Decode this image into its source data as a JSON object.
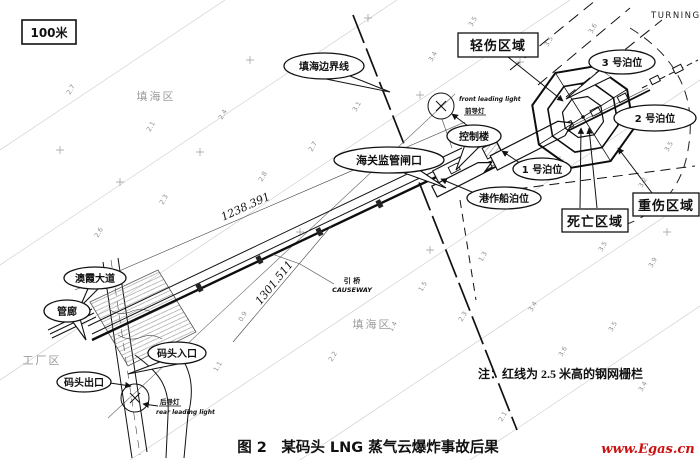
{
  "figure": {
    "scale": "100米",
    "turning": "TURNING",
    "caption": "图 2　某码头 LNG 蒸气云爆炸事故后果",
    "note": "注：红线为 2.5 米高的钢网栅栏",
    "watermark": "www.Egas.cn",
    "watermark_color": "#cc1111"
  },
  "zones": {
    "light": "轻伤区域",
    "severe": "重伤区域",
    "death": "死亡区域"
  },
  "callouts": {
    "boundary": "填海边界线",
    "control": "控制楼",
    "customs": "海关监管闸口",
    "berth1": "1 号泊位",
    "berth2": "2 号泊位",
    "berth3": "3 号泊位",
    "tug": "港作船泊位",
    "avenue": "澳霞大道",
    "pipe_rack": "管廊",
    "entrance": "码头入口",
    "exit": "码头出口"
  },
  "areas": {
    "reclaim_top": "填海区",
    "reclaim_mid": "填海区",
    "factory": "工厂区"
  },
  "lights": {
    "front_en": "front leading light",
    "front_cn": "前导灯",
    "rear_cn": "后导灯",
    "rear_en": "rear leading light"
  },
  "dims": {
    "d1": "1238.391",
    "d2": "1301.511"
  },
  "causeway": {
    "cn": "引 桥",
    "en": "CAUSEWAY"
  },
  "soundings": [
    {
      "t": "2.7",
      "x": 70,
      "y": 95
    },
    {
      "t": "2.1",
      "x": 150,
      "y": 132
    },
    {
      "t": "2.4",
      "x": 222,
      "y": 120
    },
    {
      "t": "2.3",
      "x": 163,
      "y": 205
    },
    {
      "t": "2.6",
      "x": 98,
      "y": 238
    },
    {
      "t": "2.8",
      "x": 262,
      "y": 182
    },
    {
      "t": "2.7",
      "x": 312,
      "y": 152
    },
    {
      "t": "3.1",
      "x": 356,
      "y": 112
    },
    {
      "t": "3.4",
      "x": 432,
      "y": 62
    },
    {
      "t": "3.5",
      "x": 472,
      "y": 27
    },
    {
      "t": "3.5",
      "x": 548,
      "y": 47
    },
    {
      "t": "3.6",
      "x": 592,
      "y": 34
    },
    {
      "t": "3.5",
      "x": 668,
      "y": 152
    },
    {
      "t": "3.2",
      "x": 642,
      "y": 188
    },
    {
      "t": "3.5",
      "x": 602,
      "y": 252
    },
    {
      "t": "3.9",
      "x": 652,
      "y": 268
    },
    {
      "t": "1.3",
      "x": 482,
      "y": 262
    },
    {
      "t": "1.5",
      "x": 422,
      "y": 292
    },
    {
      "t": "2.3",
      "x": 462,
      "y": 322
    },
    {
      "t": "3.4",
      "x": 532,
      "y": 312
    },
    {
      "t": "3.6",
      "x": 562,
      "y": 357
    },
    {
      "t": "3.5",
      "x": 612,
      "y": 332
    },
    {
      "t": "3.4",
      "x": 642,
      "y": 392
    },
    {
      "t": "2.1",
      "x": 502,
      "y": 422
    },
    {
      "t": "2.2",
      "x": 332,
      "y": 362
    },
    {
      "t": "1.4",
      "x": 392,
      "y": 332
    },
    {
      "t": "0.9",
      "x": 242,
      "y": 322
    },
    {
      "t": "1.1",
      "x": 217,
      "y": 372
    }
  ]
}
